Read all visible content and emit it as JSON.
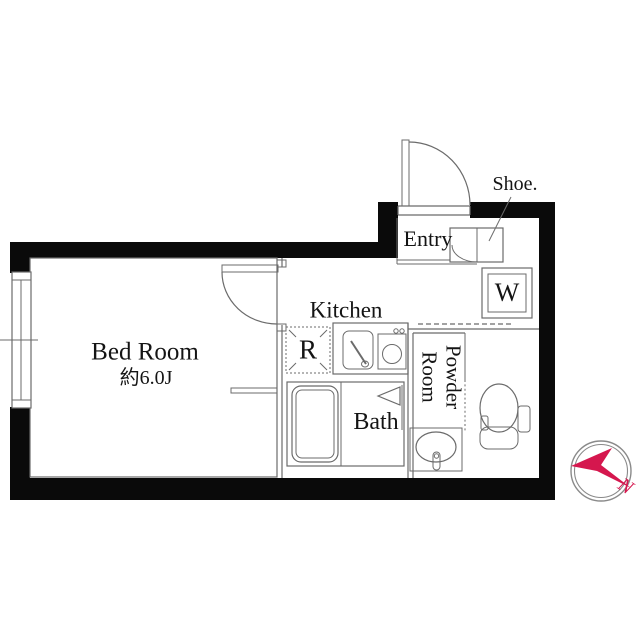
{
  "rooms": {
    "bedroom": {
      "name": "Bed Room",
      "area": "約6.0J"
    },
    "kitchen": {
      "name": "Kitchen"
    },
    "refrigerator": {
      "abbr": "R"
    },
    "bath": {
      "name": "Bath"
    },
    "powder_room": {
      "line1": "Powder",
      "line2": "Room"
    },
    "entry": {
      "name": "Entry"
    },
    "shoe_cabinet": {
      "abbr": "Shoe."
    },
    "washing_machine": {
      "abbr": "W"
    }
  },
  "compass": {
    "north": "N"
  },
  "colors": {
    "wall": "#0a0a0a",
    "line": "#6b6b6b",
    "text": "#141414",
    "compass_red": "#d5174e",
    "compass_ring": "#8a8a8a"
  }
}
